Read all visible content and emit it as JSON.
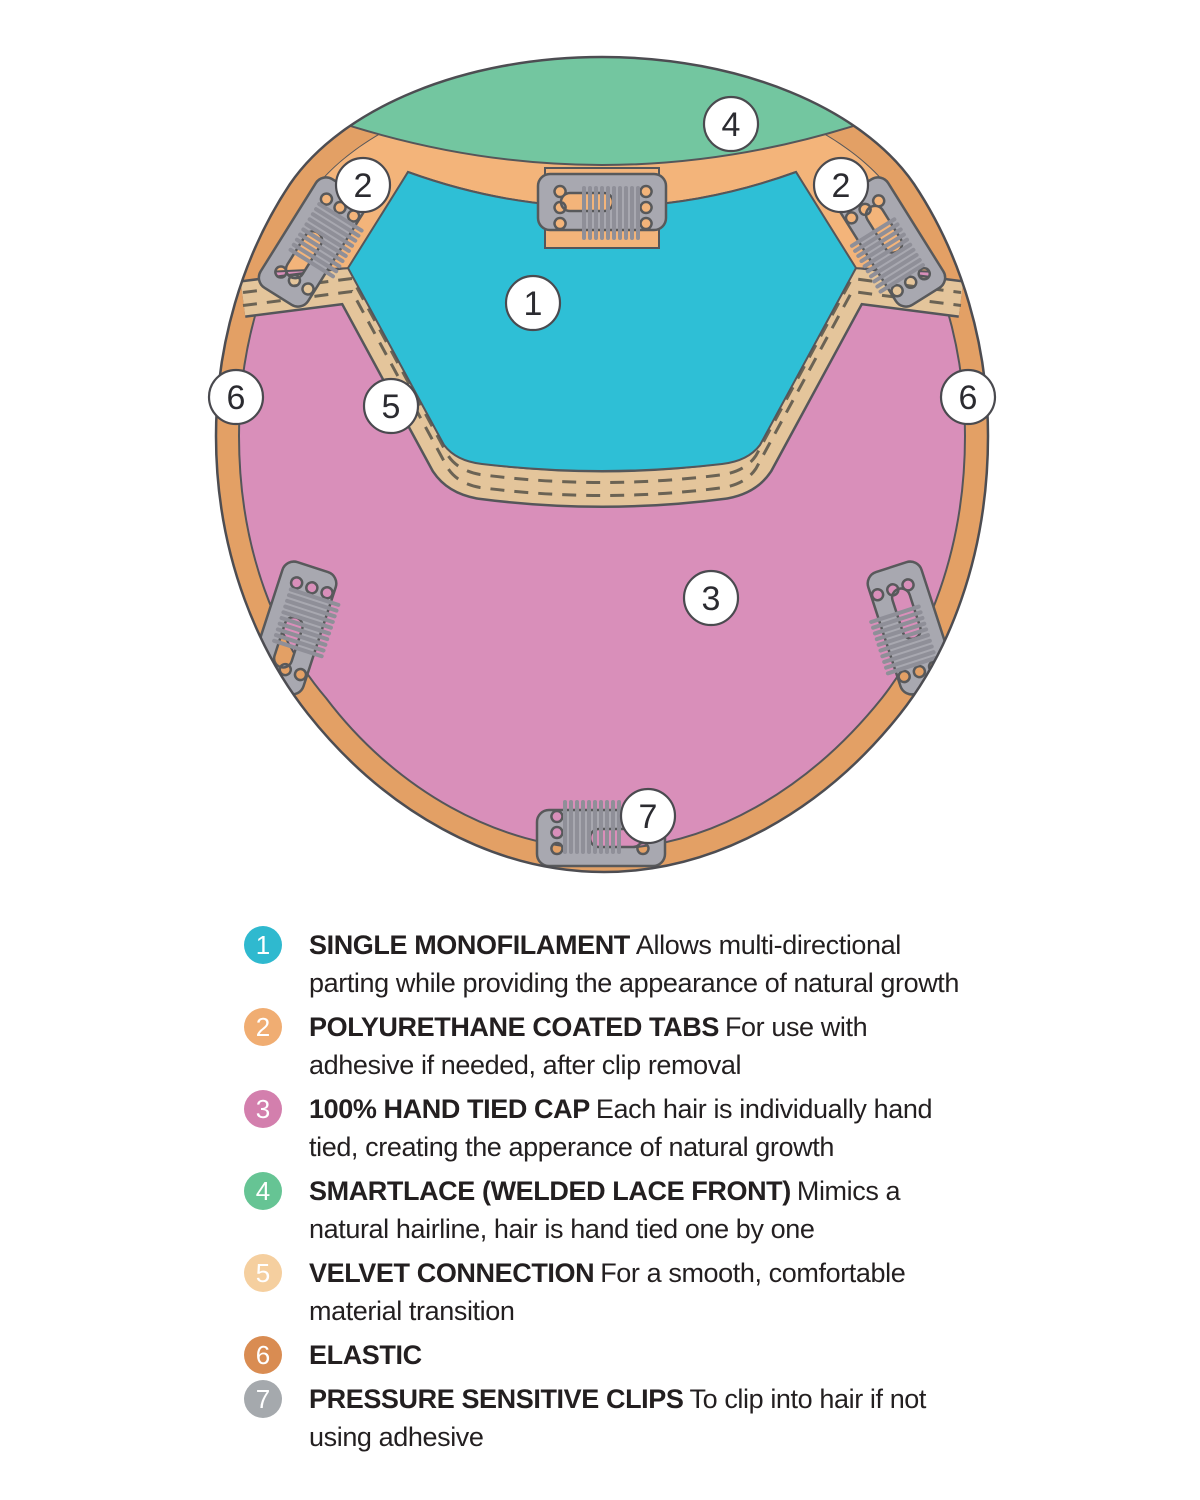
{
  "diagram": {
    "labels": [
      {
        "n": "1",
        "x": 533,
        "y": 303
      },
      {
        "n": "2",
        "x": 363,
        "y": 185
      },
      {
        "n": "2",
        "x": 841,
        "y": 185
      },
      {
        "n": "3",
        "x": 711,
        "y": 598
      },
      {
        "n": "4",
        "x": 731,
        "y": 124
      },
      {
        "n": "5",
        "x": 391,
        "y": 406
      },
      {
        "n": "6",
        "x": 236,
        "y": 397
      },
      {
        "n": "6",
        "x": 968,
        "y": 397
      },
      {
        "n": "7",
        "x": 648,
        "y": 816
      }
    ],
    "regions": [
      {
        "name": "single-monofilament",
        "color": "#2ebfd6"
      },
      {
        "name": "polyurethane-coated-tabs",
        "color": "#f3b47a"
      },
      {
        "name": "hand-tied-cap",
        "color": "#d98fba"
      },
      {
        "name": "smartlace-front",
        "color": "#73c6a0"
      },
      {
        "name": "velvet-connection",
        "color": "#e4c59b"
      },
      {
        "name": "elastic",
        "color": "#e3a065"
      },
      {
        "name": "pressure-sensitive-clips",
        "color": "#a8a8b0"
      }
    ]
  },
  "legend": {
    "items": [
      {
        "n": "1",
        "color": "#2fb9cf",
        "title": "SINGLE MONOFILAMENT",
        "description": "Allows multi-directional parting while providing the appearance of natural growth"
      },
      {
        "n": "2",
        "color": "#f0ad72",
        "title": "POLYURETHANE COATED TABS",
        "description": "For use with adhesive if needed, after clip removal"
      },
      {
        "n": "3",
        "color": "#d37fad",
        "title": "100% HAND TIED CAP",
        "description": "Each hair is individually hand tied, creating the apperance of natural growth"
      },
      {
        "n": "4",
        "color": "#66c494",
        "title": "SMARTLACE (WELDED LACE FRONT)",
        "description": "Mimics a natural hairline, hair is hand tied one by one"
      },
      {
        "n": "5",
        "color": "#f5cf9f",
        "title": "VELVET CONNECTION",
        "description": "For a smooth, comfortable material transition"
      },
      {
        "n": "6",
        "color": "#d98c52",
        "title": "ELASTIC",
        "description": ""
      },
      {
        "n": "7",
        "color": "#a5a9ad",
        "title": "PRESSURE SENSITIVE CLIPS",
        "description": "To clip into hair if not using adhesive"
      }
    ]
  }
}
